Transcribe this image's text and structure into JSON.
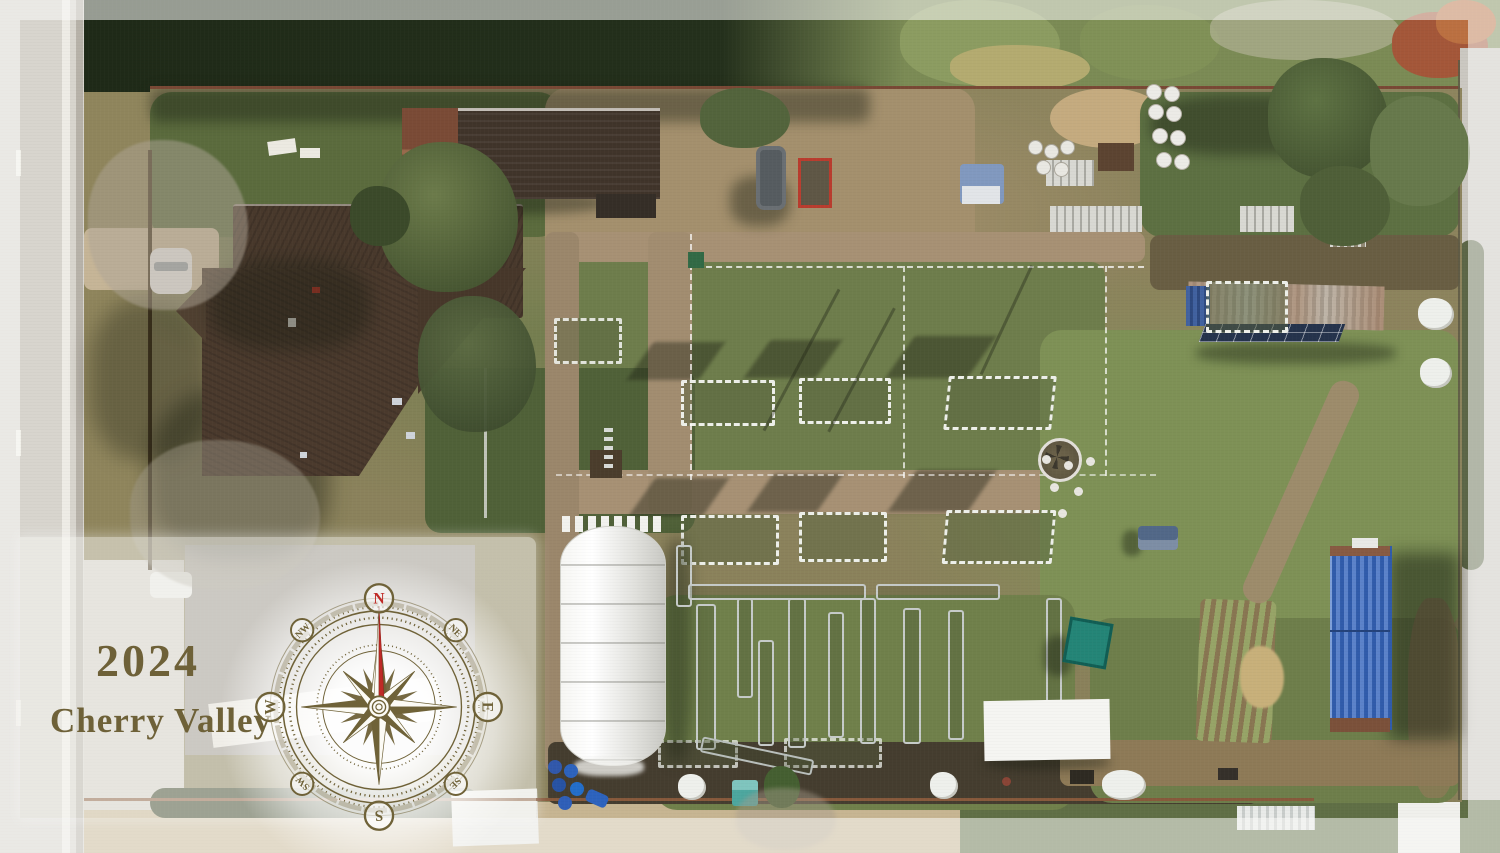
{
  "overlay": {
    "year": "2024",
    "location": "Cherry Valley",
    "text_color": "#6e6138",
    "panel_color": "rgba(250,249,246,0.52)"
  },
  "compass": {
    "color": "#6f6238",
    "north_color": "#bf2a26",
    "labels": {
      "n": "N",
      "ne": "NE",
      "e": "E",
      "se": "SE",
      "s": "S",
      "sw": "SW",
      "w": "W",
      "nw": "NW"
    }
  }
}
